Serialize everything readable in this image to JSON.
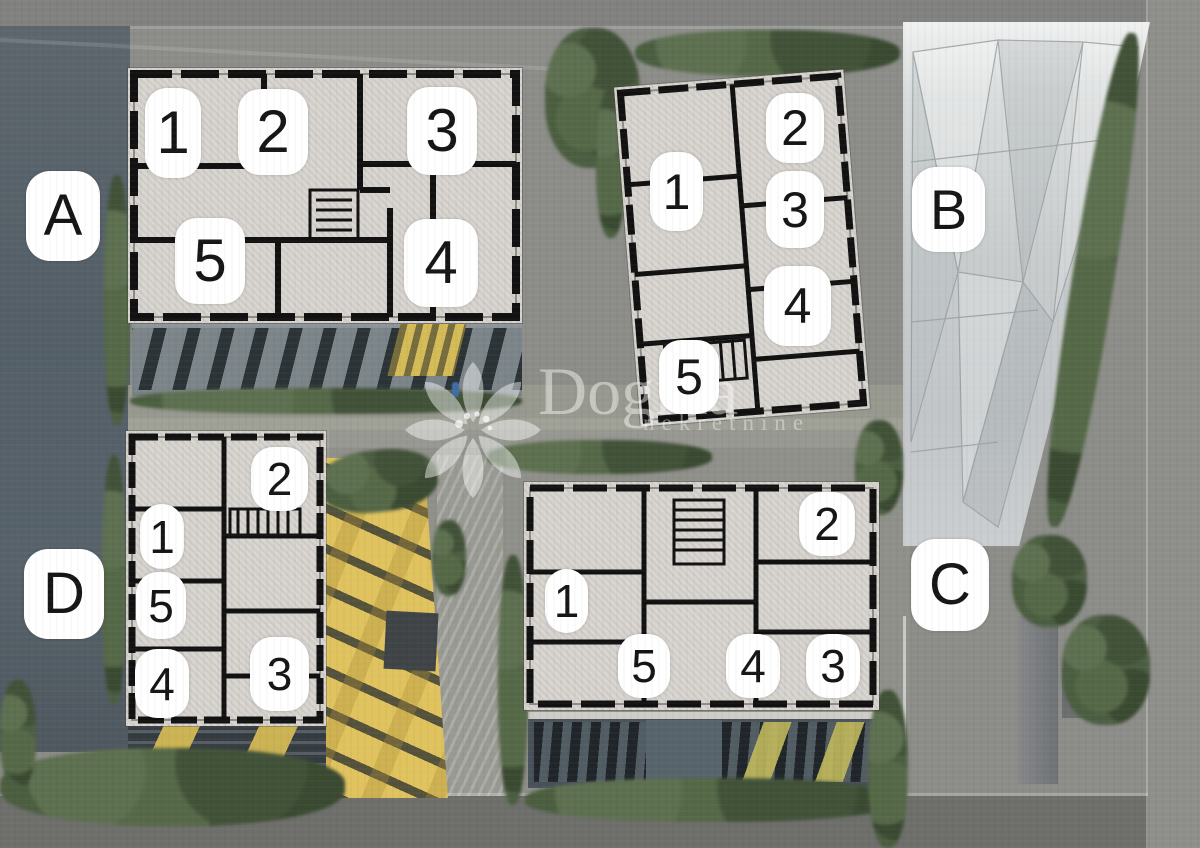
{
  "watermark": {
    "brand": "Dogma",
    "subtitle": "nekretnine",
    "logo": "pinwheel-flower"
  },
  "colors": {
    "accent_yellow": "#e0c35e",
    "badge_background": "#ffffff",
    "badge_text": "#151515",
    "hedge_green": "#4c5e42",
    "plan_paper": "#d9d6d1",
    "glass_building": "#c8cccd",
    "watermark_white": "rgba(255,255,255,0.45)"
  },
  "buildings": [
    {
      "label": "A",
      "units": [
        "1",
        "2",
        "3",
        "5",
        "4"
      ]
    },
    {
      "label": "B",
      "units": [
        "2",
        "1",
        "3",
        "4",
        "5"
      ]
    },
    {
      "label": "C",
      "units": [
        "2",
        "1",
        "5",
        "4",
        "3"
      ]
    },
    {
      "label": "D",
      "units": [
        "2",
        "1",
        "5",
        "4",
        "3"
      ]
    }
  ]
}
